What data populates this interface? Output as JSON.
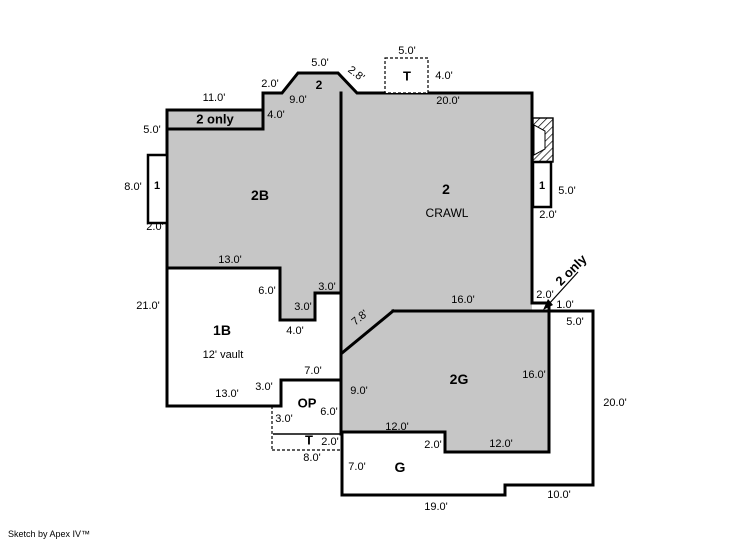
{
  "footer": {
    "credit": "Sketch by Apex IV™"
  },
  "colors": {
    "area_fill": "#c6c6c6",
    "wall": "#000000",
    "background": "#ffffff"
  },
  "rooms": [
    "2B",
    "2 CRAWL",
    "1B",
    "2G",
    "G",
    "OP",
    "T",
    "1",
    "2 only"
  ],
  "labels": [
    {
      "name": "dim-bump-5ft",
      "text": "5.0'",
      "x": 320,
      "y": 63
    },
    {
      "name": "room-label-bump-2",
      "text": "2",
      "x": 319,
      "y": 85,
      "bold": true,
      "size": 12
    },
    {
      "name": "dim-bump-2-8ft",
      "text": "2.8'",
      "x": 356,
      "y": 74,
      "rotate": 38
    },
    {
      "name": "dim-ttop-5ft",
      "text": "5.0'",
      "x": 407,
      "y": 51
    },
    {
      "name": "room-label-t-top",
      "text": "T",
      "x": 407,
      "y": 76,
      "bold": true,
      "size": 13
    },
    {
      "name": "dim-ttop-4ft",
      "text": "4.0'",
      "x": 444,
      "y": 76
    },
    {
      "name": "dim-top-2ft",
      "text": "2.0'",
      "x": 270,
      "y": 84
    },
    {
      "name": "dim-top-9ft",
      "text": "9.0'",
      "x": 298,
      "y": 100
    },
    {
      "name": "dim-top-20ft",
      "text": "20.0'",
      "x": 448,
      "y": 101
    },
    {
      "name": "dim-top-11ft",
      "text": "11.0'",
      "x": 214,
      "y": 98
    },
    {
      "name": "room-label-2only-band",
      "text": "2 only",
      "x": 215,
      "y": 119,
      "bold": true,
      "size": 13
    },
    {
      "name": "dim-band-4ft",
      "text": "4.0'",
      "x": 276,
      "y": 115
    },
    {
      "name": "dim-left-5ft",
      "text": "5.0'",
      "x": 152,
      "y": 130
    },
    {
      "name": "dim-left-8ft",
      "text": "8.0'",
      "x": 133,
      "y": 187
    },
    {
      "name": "room-label-1-left",
      "text": "1",
      "x": 157,
      "y": 186,
      "bold": true,
      "size": 11
    },
    {
      "name": "dim-left-2ft",
      "text": "2.0'",
      "x": 155,
      "y": 227
    },
    {
      "name": "room-label-2b",
      "text": "2B",
      "x": 260,
      "y": 195,
      "bold": true,
      "size": 14
    },
    {
      "name": "room-label-2",
      "text": "2",
      "x": 446,
      "y": 189,
      "bold": true,
      "size": 14
    },
    {
      "name": "room-label-crawl",
      "text": "CRAWL",
      "x": 447,
      "y": 213,
      "size": 12
    },
    {
      "name": "room-label-1-right",
      "text": "1",
      "x": 542,
      "y": 186,
      "bold": true,
      "size": 11
    },
    {
      "name": "dim-right-5ft",
      "text": "5.0'",
      "x": 567,
      "y": 191
    },
    {
      "name": "dim-right-2ft",
      "text": "2.0'",
      "x": 548,
      "y": 215
    },
    {
      "name": "dim-mid-13ft",
      "text": "13.0'",
      "x": 230,
      "y": 260
    },
    {
      "name": "dim-left-21ft",
      "text": "21.0'",
      "x": 148,
      "y": 306
    },
    {
      "name": "dim-notch-6ft",
      "text": "6.0'",
      "x": 267,
      "y": 291
    },
    {
      "name": "dim-notch-3ft-h",
      "text": "3.0'",
      "x": 327,
      "y": 287
    },
    {
      "name": "dim-notch-3ft-v",
      "text": "3.0'",
      "x": 303,
      "y": 307
    },
    {
      "name": "dim-notch-4ft",
      "text": "4.0'",
      "x": 295,
      "y": 331
    },
    {
      "name": "room-label-1b",
      "text": "1B",
      "x": 222,
      "y": 330,
      "bold": true,
      "size": 14
    },
    {
      "name": "note-12ft-vault",
      "text": "12' vault",
      "x": 223,
      "y": 355,
      "size": 11
    },
    {
      "name": "note-2only-rotated",
      "text": "2 only",
      "x": 571,
      "y": 270,
      "bold": true,
      "size": 13,
      "rotate": -45
    },
    {
      "name": "dim-corner-2ft",
      "text": "2.0'",
      "x": 545,
      "y": 295
    },
    {
      "name": "dim-corner-1ft",
      "text": "1.0'",
      "x": 565,
      "y": 305
    },
    {
      "name": "dim-corner-5ft",
      "text": "5.0'",
      "x": 575,
      "y": 322
    },
    {
      "name": "dim-mid-16ft",
      "text": "16.0'",
      "x": 463,
      "y": 300
    },
    {
      "name": "dim-diag-7-8ft",
      "text": "7.8'",
      "x": 360,
      "y": 318,
      "rotate": -40
    },
    {
      "name": "room-label-2g",
      "text": "2G",
      "x": 459,
      "y": 379,
      "bold": true,
      "size": 14
    },
    {
      "name": "dim-2g-16ft",
      "text": "16.0'",
      "x": 534,
      "y": 375
    },
    {
      "name": "dim-2g-9ft",
      "text": "9.0'",
      "x": 359,
      "y": 391
    },
    {
      "name": "dim-right-20ft",
      "text": "20.0'",
      "x": 615,
      "y": 403
    },
    {
      "name": "dim-1b-13ft",
      "text": "13.0'",
      "x": 227,
      "y": 394
    },
    {
      "name": "dim-op-3ft-step",
      "text": "3.0'",
      "x": 264,
      "y": 387
    },
    {
      "name": "dim-op-7ft",
      "text": "7.0'",
      "x": 313,
      "y": 371
    },
    {
      "name": "room-label-op",
      "text": "OP",
      "x": 307,
      "y": 403,
      "bold": true,
      "size": 13
    },
    {
      "name": "dim-op-6ft",
      "text": "6.0'",
      "x": 329,
      "y": 412
    },
    {
      "name": "dim-op-3ft-dash",
      "text": "3.0'",
      "x": 284,
      "y": 419
    },
    {
      "name": "room-label-t-bottom",
      "text": "T",
      "x": 309,
      "y": 440,
      "bold": true,
      "size": 13
    },
    {
      "name": "dim-tbottom-2ft",
      "text": "2.0'",
      "x": 330,
      "y": 442
    },
    {
      "name": "dim-tbottom-8ft",
      "text": "8.0'",
      "x": 312,
      "y": 458
    },
    {
      "name": "dim-2g-12ft-left",
      "text": "12.0'",
      "x": 397,
      "y": 427
    },
    {
      "name": "dim-g-2ft",
      "text": "2.0'",
      "x": 433,
      "y": 445
    },
    {
      "name": "dim-2g-12ft-right",
      "text": "12.0'",
      "x": 501,
      "y": 444
    },
    {
      "name": "dim-g-7ft",
      "text": "7.0'",
      "x": 357,
      "y": 467
    },
    {
      "name": "room-label-g",
      "text": "G",
      "x": 400,
      "y": 467,
      "bold": true,
      "size": 14
    },
    {
      "name": "dim-g-19ft",
      "text": "19.0'",
      "x": 436,
      "y": 507
    },
    {
      "name": "dim-g-10ft",
      "text": "10.0'",
      "x": 559,
      "y": 495
    }
  ]
}
